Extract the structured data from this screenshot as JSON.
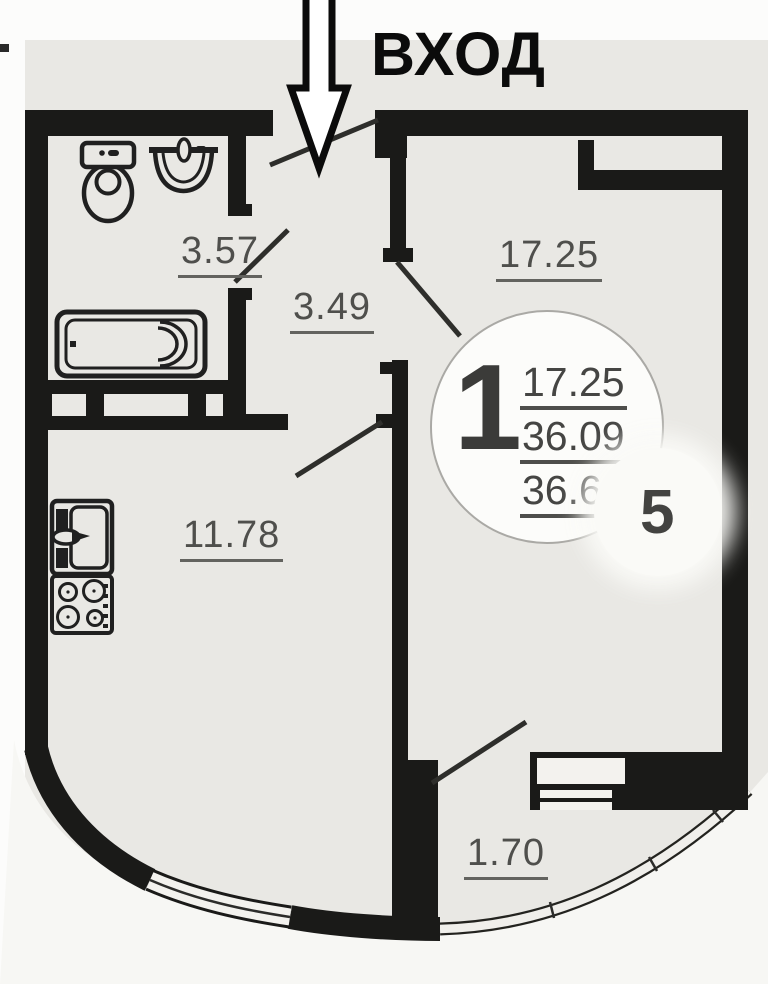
{
  "entrance": {
    "label": "ВХОД"
  },
  "areas": {
    "bathroom": "3.57",
    "hallway": "3.49",
    "living_room": "17.25",
    "kitchen": "11.78",
    "balcony": "1.70"
  },
  "unit_info": {
    "room_count": "1",
    "living_area": "17.25",
    "usable_area": "36.09",
    "total_area": "36.60",
    "unit_number": "5"
  },
  "fixtures": [
    "toilet",
    "washbasin",
    "bathtub",
    "kitchen-sink",
    "stove"
  ],
  "colors": {
    "wall": "#1a1a18",
    "paper": "#e9e8e4",
    "label": "#4f4f4c",
    "ink": "#0b0b0b"
  }
}
